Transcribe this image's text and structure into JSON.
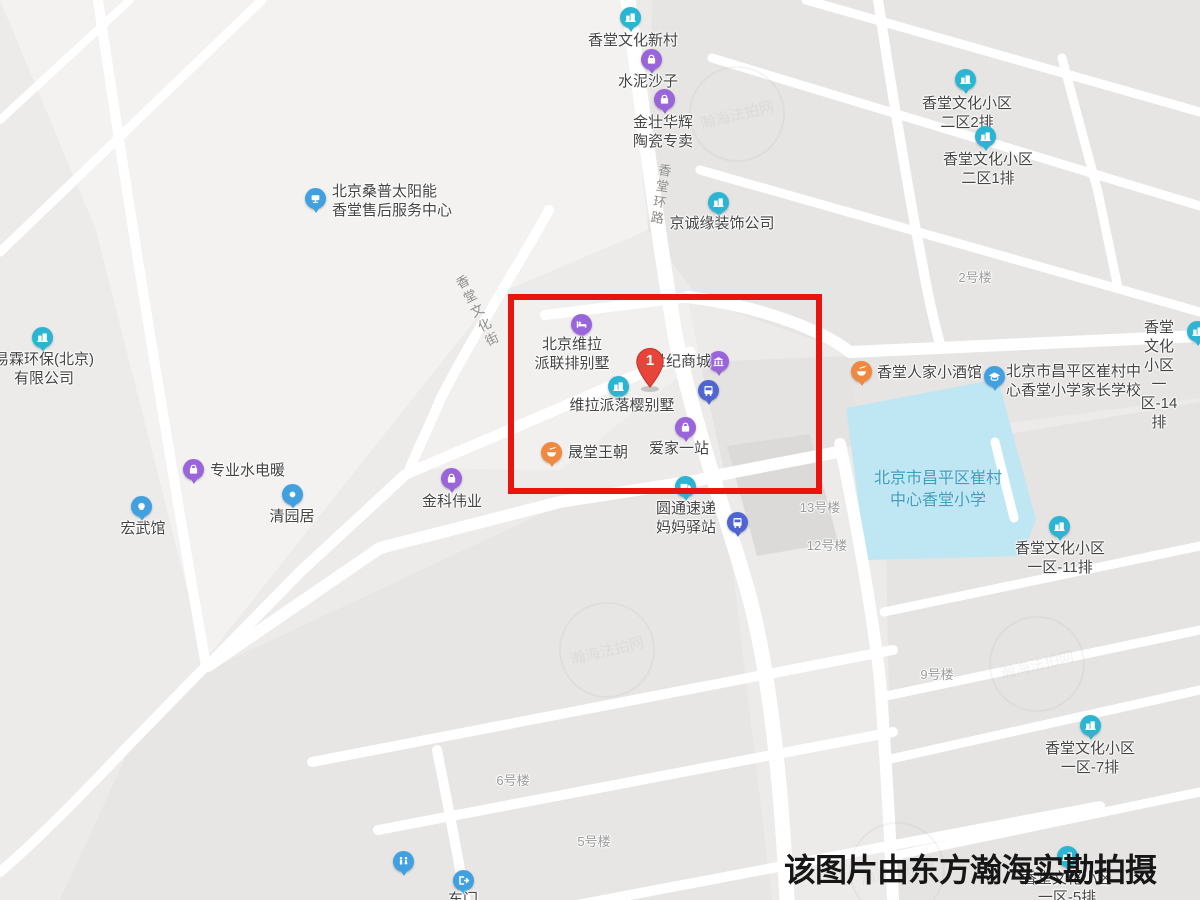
{
  "caption": {
    "text": "该图片由东方瀚海实勘拍摄",
    "x": 784,
    "y": 845
  },
  "watermark": {
    "text": "瀚海法拍网"
  },
  "highlight": {
    "x": 508,
    "y": 294,
    "w": 314,
    "h": 200,
    "label": "1",
    "marker_x": 650,
    "marker_y": 388
  },
  "colors": {
    "teal": "#2bb5d2",
    "purple": "#9a65da",
    "blue": "#41a1e0",
    "orange": "#f0883f",
    "indigo": "#5064d2",
    "marker_red": "#e8443a",
    "school_fill": "#bfe6f3",
    "highlight_red": "#e8140e"
  },
  "map": {
    "road_labels": [
      {
        "id": "xiangtang-huanlu",
        "text": "香堂环路",
        "x": 660,
        "y": 195,
        "rotate": 9
      },
      {
        "id": "xiangtang-wenhuajie",
        "text": "香堂文化街",
        "x": 477,
        "y": 312,
        "rotate": -27
      }
    ],
    "pois": [
      {
        "id": "xiangtang-wenhua-xincun",
        "icon": "building",
        "color": "teal",
        "pin": [
          630,
          17
        ],
        "label": {
          "lines": [
            "香堂文化新村"
          ],
          "x": 633,
          "y": 40,
          "align": "center"
        }
      },
      {
        "id": "shuini-shazi",
        "icon": "bag",
        "color": "purple",
        "pin": [
          651,
          59
        ],
        "label": {
          "lines": [
            "水泥沙子"
          ],
          "x": 648,
          "y": 81,
          "align": "center"
        }
      },
      {
        "id": "jinzhuang-huahui-taoci",
        "icon": "bag",
        "color": "purple",
        "pin": [
          664,
          99
        ],
        "label": {
          "lines": [
            "金壮华辉",
            "陶瓷专卖"
          ],
          "x": 663,
          "y": 122,
          "align": "center"
        }
      },
      {
        "id": "sangpu-service-center",
        "icon": "solar",
        "color": "blue",
        "pin": [
          315,
          198
        ],
        "label": {
          "lines": [
            "北京桑普太阳能",
            "香堂售后服务中心"
          ],
          "x": 332,
          "y": 191,
          "align": "left"
        }
      },
      {
        "id": "jingchengyuan-zhuangshi",
        "icon": "building",
        "color": "teal",
        "pin": [
          718,
          202
        ],
        "label": {
          "lines": [
            "京诚缘装饰公司"
          ],
          "x": 722,
          "y": 223,
          "align": "center"
        }
      },
      {
        "id": "erqu-2pai",
        "icon": "building",
        "color": "teal",
        "pin": [
          965,
          79
        ],
        "label": {
          "lines": [
            "香堂文化小区",
            "二区2排"
          ],
          "x": 967,
          "y": 103,
          "align": "center"
        }
      },
      {
        "id": "erqu-1pai",
        "icon": "building",
        "color": "teal",
        "pin": [
          985,
          136
        ],
        "label": {
          "lines": [
            "香堂文化小区",
            "二区1排"
          ],
          "x": 988,
          "y": 159,
          "align": "center"
        }
      },
      {
        "id": "louhao-2",
        "label": {
          "lines": [
            "2号楼"
          ],
          "x": 975,
          "y": 277,
          "align": "center",
          "cls": "gray"
        }
      },
      {
        "id": "weila-lianpai-bieshu",
        "icon": "bed",
        "color": "purple",
        "pin": [
          581,
          324
        ],
        "label": {
          "lines": [
            "北京维拉",
            "派联排别墅"
          ],
          "x": 572,
          "y": 344,
          "align": "center"
        }
      },
      {
        "id": "shiji-shangcheng",
        "icon": "shop",
        "color": "purple",
        "pin": [
          718,
          361
        ],
        "label": {
          "lines": [
            "世纪商城"
          ],
          "x": 681,
          "y": 361,
          "align": "center"
        }
      },
      {
        "id": "bus-stop-north",
        "icon": "bus",
        "color": "indigo",
        "pin": [
          708,
          390
        ]
      },
      {
        "id": "weila-luoying-bieshu",
        "icon": "building",
        "color": "teal",
        "pin": [
          618,
          386
        ],
        "label": {
          "lines": [
            "维拉派落樱别墅"
          ],
          "x": 622,
          "y": 405,
          "align": "center"
        }
      },
      {
        "id": "shengtang-wangchao",
        "icon": "food",
        "color": "orange",
        "pin": [
          551,
          452
        ],
        "label": {
          "lines": [
            "晟堂王朝"
          ],
          "x": 568,
          "y": 452,
          "align": "left"
        }
      },
      {
        "id": "aijia-yizhan",
        "icon": "bag",
        "color": "purple",
        "pin": [
          685,
          427
        ],
        "label": {
          "lines": [
            "爱家一站"
          ],
          "x": 679,
          "y": 448,
          "align": "center"
        }
      },
      {
        "id": "xiangtang-renjia-jiuguan",
        "icon": "food",
        "color": "orange",
        "pin": [
          861,
          371
        ],
        "label": {
          "lines": [
            "香堂人家小酒馆"
          ],
          "x": 877,
          "y": 372,
          "align": "left"
        }
      },
      {
        "id": "cuicun-parent-school",
        "icon": "school",
        "color": "blue",
        "pin": [
          994,
          376
        ],
        "label": {
          "lines": [
            "北京市昌平区崔村中",
            "心香堂小学家长学校"
          ],
          "x": 1006,
          "y": 371,
          "align": "left"
        }
      },
      {
        "id": "yiqu-14pai",
        "icon": "building",
        "color": "teal",
        "pin": [
          1197,
          331
        ],
        "label": {
          "lines": [
            "香堂文化小区",
            "一区-14排"
          ],
          "x": 1159,
          "y": 327,
          "align": "center"
        }
      },
      {
        "id": "yilin-huanbao",
        "icon": "building",
        "color": "teal",
        "pin": [
          42,
          337
        ],
        "label": {
          "lines": [
            "易霖环保(北京)",
            "有限公司"
          ],
          "x": 44,
          "y": 359,
          "align": "center"
        }
      },
      {
        "id": "zhuanye-shuidiannuan",
        "icon": "bag",
        "color": "purple",
        "pin": [
          193,
          469
        ],
        "label": {
          "lines": [
            "专业水电暖"
          ],
          "x": 210,
          "y": 470,
          "align": "left"
        }
      },
      {
        "id": "hongwuguan",
        "icon": "fist",
        "color": "blue",
        "pin": [
          141,
          506
        ],
        "label": {
          "lines": [
            "宏武馆"
          ],
          "x": 143,
          "y": 528,
          "align": "center"
        }
      },
      {
        "id": "qingyuanju",
        "icon": "dot",
        "color": "blue",
        "pin": [
          292,
          494
        ],
        "label": {
          "lines": [
            "清园居"
          ],
          "x": 292,
          "y": 516,
          "align": "center"
        }
      },
      {
        "id": "jinke-weiye",
        "icon": "bag",
        "color": "purple",
        "pin": [
          451,
          478
        ],
        "label": {
          "lines": [
            "金科伟业"
          ],
          "x": 452,
          "y": 501,
          "align": "center"
        }
      },
      {
        "id": "yuantong-mama-yizhan",
        "icon": "truck",
        "color": "teal",
        "pin": [
          685,
          486
        ],
        "label": {
          "lines": [
            "圆通速递",
            "妈妈驿站"
          ],
          "x": 686,
          "y": 508,
          "align": "center"
        }
      },
      {
        "id": "bus-stop-south",
        "icon": "bus",
        "color": "indigo",
        "pin": [
          737,
          522
        ]
      },
      {
        "id": "louhao-13",
        "label": {
          "lines": [
            "13号楼"
          ],
          "x": 820,
          "y": 507,
          "align": "center",
          "cls": "gray"
        }
      },
      {
        "id": "louhao-12",
        "label": {
          "lines": [
            "12号楼"
          ],
          "x": 827,
          "y": 545,
          "align": "center",
          "cls": "gray"
        }
      },
      {
        "id": "cuicun-xiangtang-primary-school",
        "label": {
          "lines": [
            "北京市昌平区崔村",
            "中心香堂小学"
          ],
          "x": 938,
          "y": 479,
          "align": "center",
          "cls": "school"
        }
      },
      {
        "id": "yiqu-11pai",
        "icon": "building",
        "color": "teal",
        "pin": [
          1059,
          526
        ],
        "label": {
          "lines": [
            "香堂文化小区",
            "一区-11排"
          ],
          "x": 1060,
          "y": 548,
          "align": "center"
        }
      },
      {
        "id": "louhao-9",
        "label": {
          "lines": [
            "9号楼"
          ],
          "x": 937,
          "y": 674,
          "align": "center",
          "cls": "gray"
        }
      },
      {
        "id": "yiqu-7pai",
        "icon": "building",
        "color": "teal",
        "pin": [
          1090,
          725
        ],
        "label": {
          "lines": [
            "香堂文化小区",
            "一区-7排"
          ],
          "x": 1090,
          "y": 748,
          "align": "center"
        }
      },
      {
        "id": "louhao-6",
        "label": {
          "lines": [
            "6号楼"
          ],
          "x": 513,
          "y": 780,
          "align": "center",
          "cls": "gray"
        }
      },
      {
        "id": "louhao-5",
        "label": {
          "lines": [
            "5号楼"
          ],
          "x": 594,
          "y": 841,
          "align": "center",
          "cls": "gray"
        }
      },
      {
        "id": "restroom",
        "icon": "wc",
        "color": "blue",
        "pin": [
          403,
          861
        ]
      },
      {
        "id": "dongmen",
        "icon": "exit",
        "color": "blue",
        "pin": [
          463,
          880
        ],
        "label": {
          "lines": [
            "东门"
          ],
          "x": 463,
          "y": 899,
          "align": "center"
        }
      },
      {
        "id": "yiqu-5pai",
        "icon": "building",
        "color": "teal",
        "pin": [
          1067,
          856
        ],
        "label": {
          "lines": [
            "香堂文化小区",
            "一区-5排"
          ],
          "x": 1067,
          "y": 878,
          "align": "center"
        }
      }
    ]
  }
}
